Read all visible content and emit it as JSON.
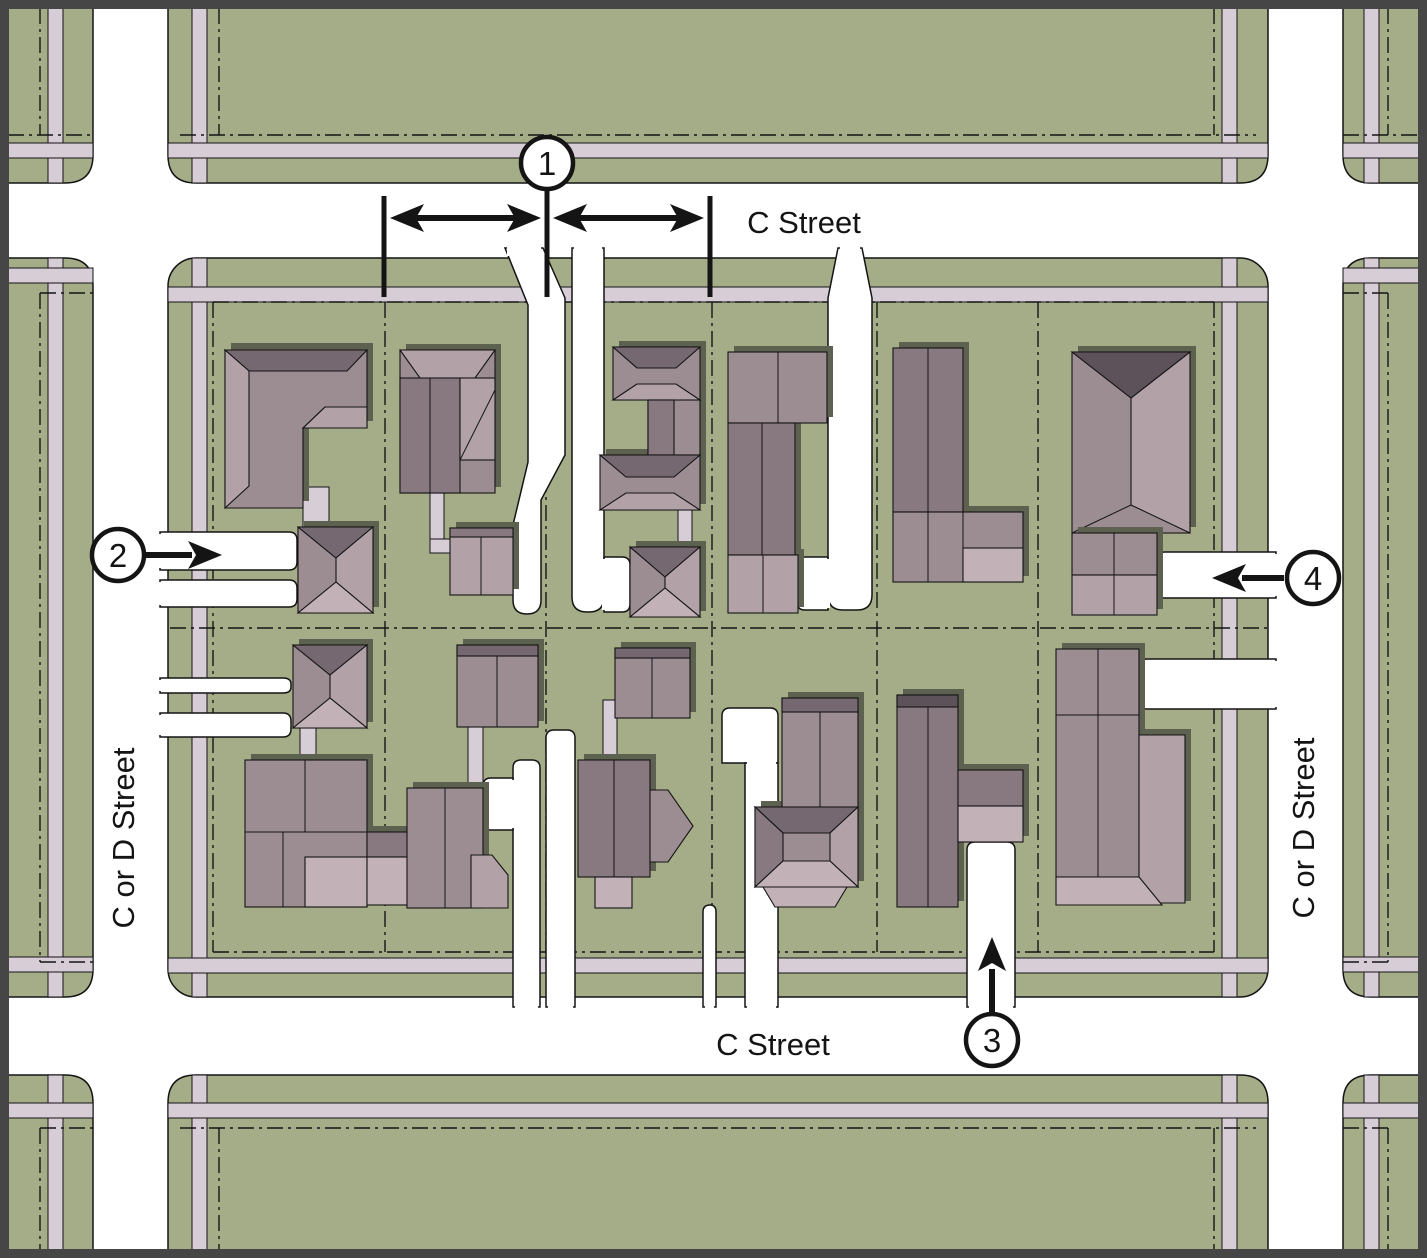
{
  "diagram": {
    "type": "residential-block-site-plan",
    "street_labels": {
      "top": "C Street",
      "bottom": "C Street",
      "left": "C or D Street",
      "right": "C or D Street"
    },
    "callouts": [
      {
        "number": "1"
      },
      {
        "number": "2"
      },
      {
        "number": "3"
      },
      {
        "number": "4"
      }
    ],
    "colors": {
      "street": "#ffffff",
      "block_green": "#a5ad88",
      "sidewalk": "#d7cdd7",
      "building_wall": "#9c8d93",
      "building_wall_light": "#b2a2a8",
      "building_wall_dark": "#87797f",
      "building_porch_light": "#c2b2b7",
      "roof_dark": "#756871",
      "roof_darkest": "#5e525a",
      "building_shadow": "#5d6150",
      "line": "#141414",
      "frame": "#464646"
    }
  }
}
